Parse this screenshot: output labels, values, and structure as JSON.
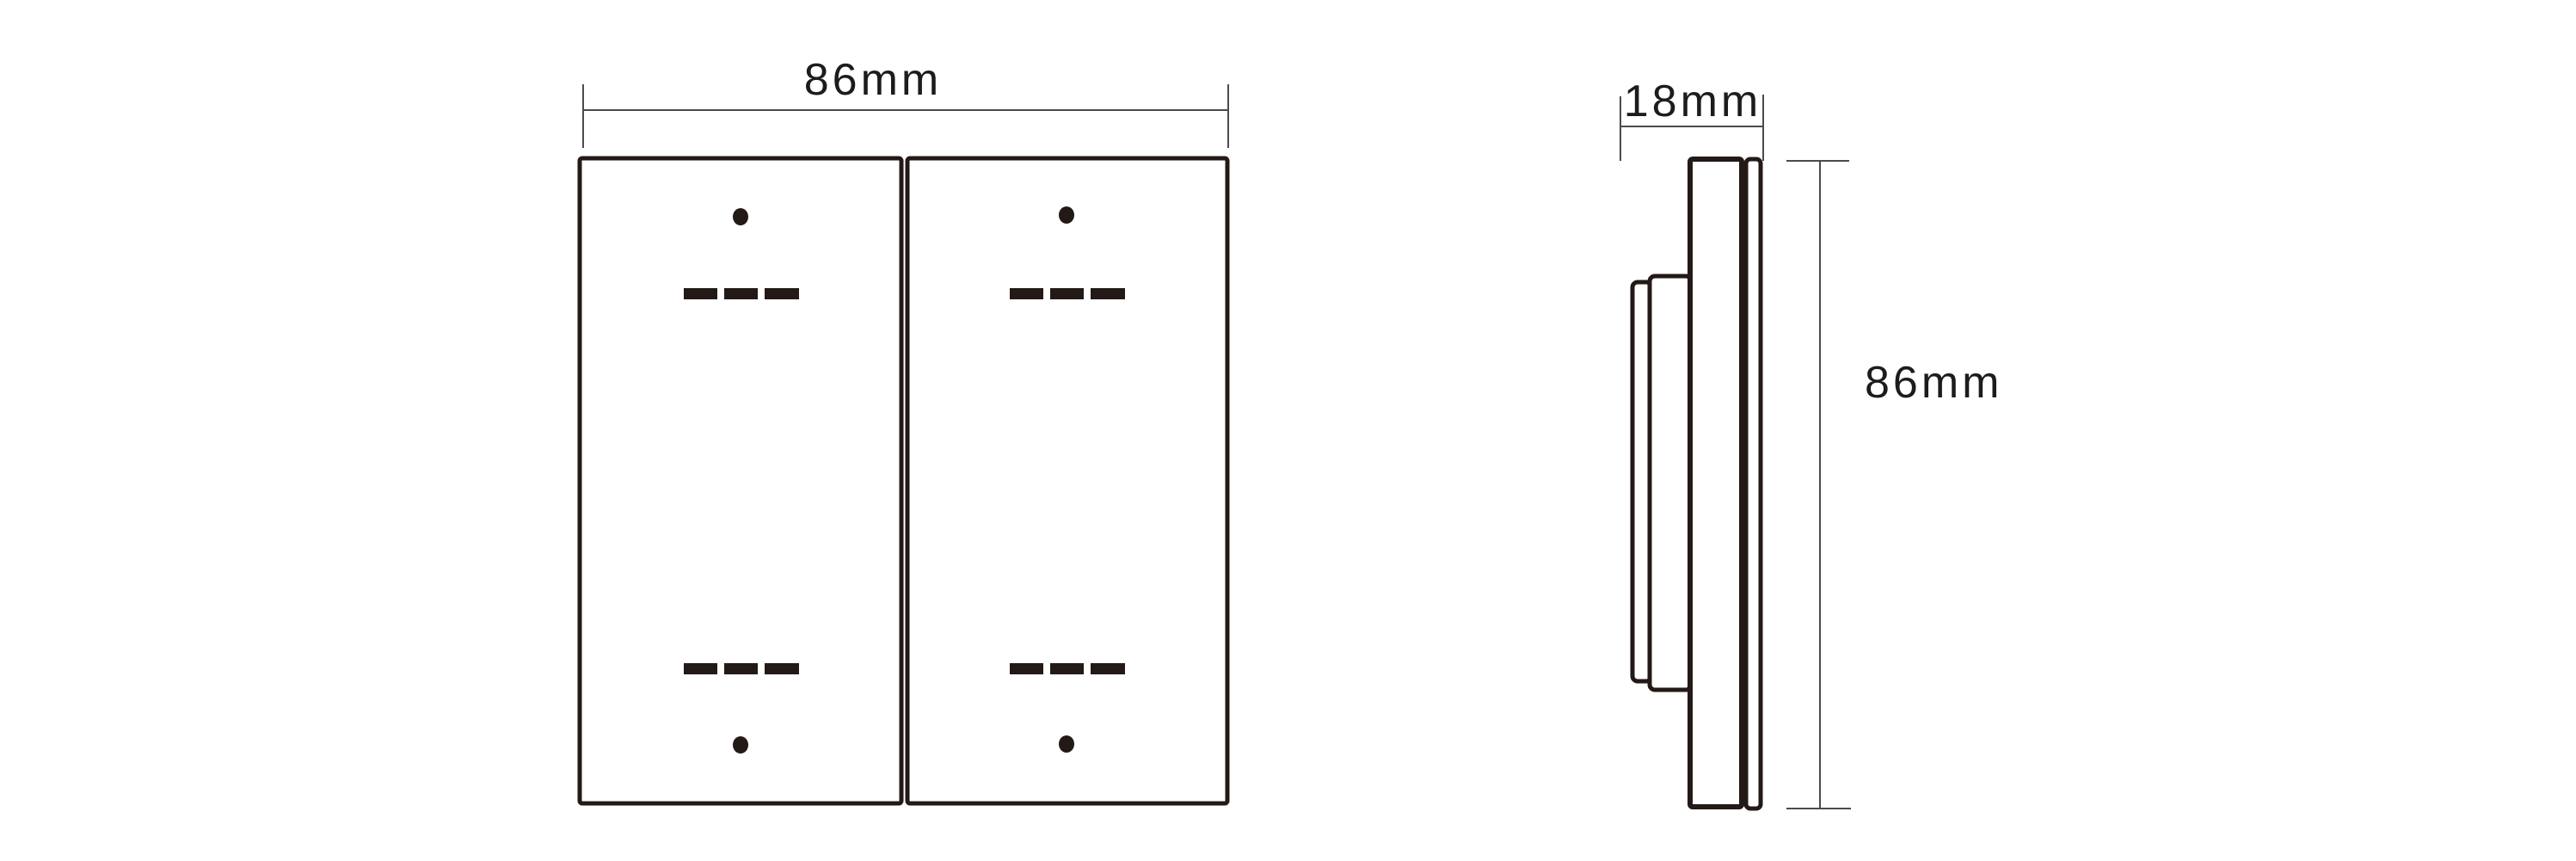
{
  "colors": {
    "background": "#ffffff",
    "outline": "#231916",
    "dimension_line": "#4b4b4b",
    "text": "#1c1c1c"
  },
  "front_view": {
    "width_label": "86mm"
  },
  "side_view": {
    "depth_label": "18mm",
    "height_label": "86mm"
  }
}
